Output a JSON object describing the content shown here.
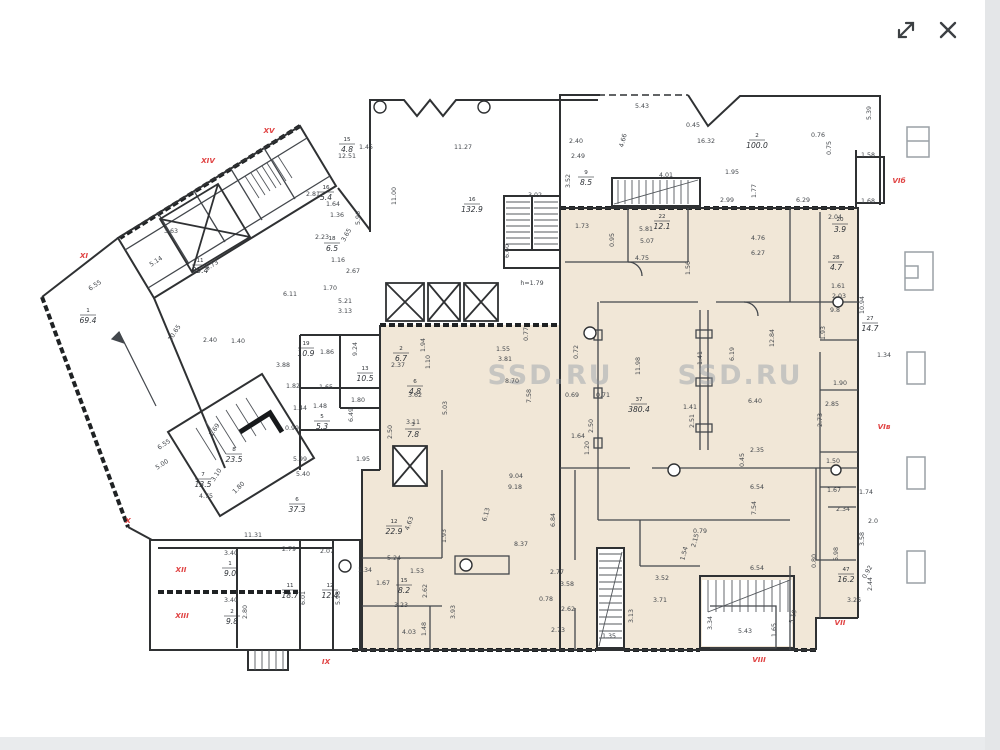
{
  "viewer": {
    "icons": [
      "expand-icon",
      "close-icon"
    ]
  },
  "watermark": {
    "text": "SSD.RU"
  },
  "colors": {
    "beige_zone": "#f1e7d7",
    "wall": "#2f3133",
    "red_label": "#e04343",
    "watermark_gray": "#8d97a3"
  },
  "plan": {
    "red_labels": [
      {
        "t": "XV",
        "x": 269,
        "y": 133
      },
      {
        "t": "XIV",
        "x": 208,
        "y": 163
      },
      {
        "t": "XI",
        "x": 84,
        "y": 258
      },
      {
        "t": "X",
        "x": 128,
        "y": 523
      },
      {
        "t": "XII",
        "x": 181,
        "y": 572
      },
      {
        "t": "XIII",
        "x": 182,
        "y": 618
      },
      {
        "t": "IX",
        "x": 326,
        "y": 664
      },
      {
        "t": "VIII",
        "x": 759,
        "y": 662
      },
      {
        "t": "VII",
        "x": 840,
        "y": 625
      },
      {
        "t": "VIб",
        "x": 899,
        "y": 183
      },
      {
        "t": "VIв",
        "x": 884,
        "y": 429
      }
    ],
    "rooms": [
      {
        "num": "11",
        "area": "35.4",
        "x": 200,
        "y": 270
      },
      {
        "num": "16",
        "area": "132.9",
        "x": 472,
        "y": 209
      },
      {
        "num": "2",
        "area": "100.0",
        "x": 757,
        "y": 145
      },
      {
        "num": "1",
        "area": "69.4",
        "x": 88,
        "y": 320
      },
      {
        "num": "7",
        "area": "13.5",
        "x": 203,
        "y": 484
      },
      {
        "num": "8",
        "area": "23.5",
        "x": 234,
        "y": 459
      },
      {
        "num": "6",
        "area": "37.3",
        "x": 297,
        "y": 509
      },
      {
        "num": "12",
        "area": "22.9",
        "x": 394,
        "y": 531
      },
      {
        "num": "37",
        "area": "380.4",
        "x": 639,
        "y": 409
      },
      {
        "num": "13",
        "area": "10.5",
        "x": 365,
        "y": 378
      },
      {
        "num": "47",
        "area": "16.2",
        "x": 846,
        "y": 579
      },
      {
        "num": "27",
        "area": "14.7",
        "x": 870,
        "y": 328
      },
      {
        "num": "1",
        "area": "9.0",
        "x": 230,
        "y": 573
      },
      {
        "num": "2",
        "area": "9.8",
        "x": 232,
        "y": 621
      },
      {
        "num": "15",
        "area": "8.2",
        "x": 404,
        "y": 590
      },
      {
        "num": "19",
        "area": "10.9",
        "x": 306,
        "y": 353
      },
      {
        "num": "22",
        "area": "12.1",
        "x": 662,
        "y": 226
      },
      {
        "num": "9",
        "area": "8.5",
        "x": 586,
        "y": 182
      },
      {
        "num": "2",
        "area": "6.7",
        "x": 401,
        "y": 358
      },
      {
        "num": "6",
        "area": "4.8",
        "x": 415,
        "y": 391
      },
      {
        "num": "3",
        "area": "7.8",
        "x": 413,
        "y": 434
      },
      {
        "num": "20",
        "area": "3.9",
        "x": 840,
        "y": 229
      },
      {
        "num": "28",
        "area": "4.7",
        "x": 836,
        "y": 267
      },
      {
        "num": "15",
        "area": "4.8",
        "x": 347,
        "y": 149
      },
      {
        "num": "16",
        "area": "5.4",
        "x": 326,
        "y": 197
      },
      {
        "num": "18",
        "area": "6.5",
        "x": 332,
        "y": 248
      },
      {
        "num": "5",
        "area": "5.3",
        "x": 322,
        "y": 426
      },
      {
        "num": "11",
        "area": "18.7",
        "x": 290,
        "y": 595
      },
      {
        "num": "12",
        "area": "12.4",
        "x": 330,
        "y": 595
      }
    ],
    "dims": [
      {
        "t": "3.63",
        "x": 171,
        "y": 233
      },
      {
        "t": "5.14",
        "x": 157,
        "y": 263,
        "r": -33
      },
      {
        "t": "6.55",
        "x": 96,
        "y": 287,
        "r": -33
      },
      {
        "t": "9.73",
        "x": 213,
        "y": 267,
        "r": -33
      },
      {
        "t": "10.65",
        "x": 176,
        "y": 334,
        "r": -57
      },
      {
        "t": "2.40",
        "x": 210,
        "y": 342
      },
      {
        "t": "1.40",
        "x": 238,
        "y": 343
      },
      {
        "t": "12.51",
        "x": 347,
        "y": 158
      },
      {
        "t": "1.45",
        "x": 366,
        "y": 149
      },
      {
        "t": "2.81",
        "x": 313,
        "y": 196
      },
      {
        "t": "1.64",
        "x": 333,
        "y": 206
      },
      {
        "t": "1.36",
        "x": 337,
        "y": 217
      },
      {
        "t": "5.96",
        "x": 360,
        "y": 218,
        "r": -90
      },
      {
        "t": "3.65",
        "x": 348,
        "y": 236,
        "r": -60
      },
      {
        "t": "2.23",
        "x": 322,
        "y": 239
      },
      {
        "t": "1.16",
        "x": 338,
        "y": 262
      },
      {
        "t": "2.67",
        "x": 353,
        "y": 273
      },
      {
        "t": "1.70",
        "x": 330,
        "y": 290
      },
      {
        "t": "5.21",
        "x": 345,
        "y": 303
      },
      {
        "t": "3.13",
        "x": 345,
        "y": 313
      },
      {
        "t": "6.11",
        "x": 290,
        "y": 296
      },
      {
        "t": "3.88",
        "x": 283,
        "y": 367
      },
      {
        "t": "1.86",
        "x": 327,
        "y": 354
      },
      {
        "t": "9.24",
        "x": 357,
        "y": 349,
        "r": -90
      },
      {
        "t": "2.37",
        "x": 398,
        "y": 367
      },
      {
        "t": "1.82",
        "x": 293,
        "y": 388
      },
      {
        "t": "1.65",
        "x": 326,
        "y": 389
      },
      {
        "t": "1.80",
        "x": 358,
        "y": 402
      },
      {
        "t": "6.49",
        "x": 353,
        "y": 415,
        "r": -90
      },
      {
        "t": "0.99",
        "x": 292,
        "y": 430
      },
      {
        "t": "1.44",
        "x": 300,
        "y": 410
      },
      {
        "t": "1.48",
        "x": 320,
        "y": 408
      },
      {
        "t": "3.11",
        "x": 413,
        "y": 424
      },
      {
        "t": "2.50",
        "x": 392,
        "y": 432,
        "r": -90
      },
      {
        "t": "1.10",
        "x": 430,
        "y": 362,
        "r": -90
      },
      {
        "t": "1.94",
        "x": 425,
        "y": 345,
        "r": -90
      },
      {
        "t": "3.62",
        "x": 415,
        "y": 397
      },
      {
        "t": "5.03",
        "x": 447,
        "y": 408,
        "r": -90
      },
      {
        "t": "5.99",
        "x": 300,
        "y": 461
      },
      {
        "t": "5.40",
        "x": 303,
        "y": 476
      },
      {
        "t": "1.95",
        "x": 363,
        "y": 461
      },
      {
        "t": "6.55",
        "x": 165,
        "y": 446,
        "r": -33
      },
      {
        "t": "5.00",
        "x": 163,
        "y": 466,
        "r": -33
      },
      {
        "t": "3.10",
        "x": 218,
        "y": 476,
        "r": -57
      },
      {
        "t": "1.69",
        "x": 216,
        "y": 431,
        "r": -57
      },
      {
        "t": "4.75",
        "x": 206,
        "y": 498
      },
      {
        "t": "1.80",
        "x": 240,
        "y": 489,
        "r": -45
      },
      {
        "t": "11.27",
        "x": 463,
        "y": 149
      },
      {
        "t": "11.00",
        "x": 396,
        "y": 196,
        "r": -90
      },
      {
        "t": "3.02",
        "x": 535,
        "y": 197
      },
      {
        "t": "6.60",
        "x": 509,
        "y": 251,
        "r": -90
      },
      {
        "t": "h=1.79",
        "x": 532,
        "y": 285
      },
      {
        "t": "2.40",
        "x": 576,
        "y": 143
      },
      {
        "t": "2.49",
        "x": 578,
        "y": 158
      },
      {
        "t": "3.52",
        "x": 570,
        "y": 181,
        "r": -90
      },
      {
        "t": "1.73",
        "x": 582,
        "y": 228
      },
      {
        "t": "0.95",
        "x": 614,
        "y": 240,
        "r": -90
      },
      {
        "t": "5.81",
        "x": 646,
        "y": 231
      },
      {
        "t": "5.07",
        "x": 647,
        "y": 243
      },
      {
        "t": "4.75",
        "x": 642,
        "y": 260
      },
      {
        "t": "1.56",
        "x": 690,
        "y": 268,
        "r": -90
      },
      {
        "t": "4.76",
        "x": 758,
        "y": 240
      },
      {
        "t": "6.27",
        "x": 758,
        "y": 255
      },
      {
        "t": "2.99",
        "x": 727,
        "y": 202
      },
      {
        "t": "1.95",
        "x": 732,
        "y": 174
      },
      {
        "t": "1.77",
        "x": 756,
        "y": 191,
        "r": -90
      },
      {
        "t": "6.29",
        "x": 803,
        "y": 202
      },
      {
        "t": "1.68",
        "x": 868,
        "y": 203
      },
      {
        "t": "1.58",
        "x": 868,
        "y": 157
      },
      {
        "t": "5.39",
        "x": 871,
        "y": 113,
        "r": -90
      },
      {
        "t": "0.76",
        "x": 818,
        "y": 137
      },
      {
        "t": "0.75",
        "x": 831,
        "y": 148,
        "r": -90
      },
      {
        "t": "4.01",
        "x": 666,
        "y": 177
      },
      {
        "t": "5.43",
        "x": 642,
        "y": 108
      },
      {
        "t": "0.45",
        "x": 693,
        "y": 127
      },
      {
        "t": "4.66",
        "x": 625,
        "y": 141,
        "r": -75
      },
      {
        "t": "16.32",
        "x": 706,
        "y": 143
      },
      {
        "t": "2.04",
        "x": 835,
        "y": 219
      },
      {
        "t": "2.03",
        "x": 839,
        "y": 298
      },
      {
        "t": "1.61",
        "x": 838,
        "y": 288
      },
      {
        "t": "9.8",
        "x": 835,
        "y": 312
      },
      {
        "t": "10.94",
        "x": 864,
        "y": 305,
        "r": -90
      },
      {
        "t": "1.93",
        "x": 825,
        "y": 333,
        "r": -90
      },
      {
        "t": "1.90",
        "x": 840,
        "y": 385
      },
      {
        "t": "1.34",
        "x": 884,
        "y": 357
      },
      {
        "t": "2.85",
        "x": 832,
        "y": 406
      },
      {
        "t": "2.73",
        "x": 822,
        "y": 420,
        "r": -90
      },
      {
        "t": "1.55",
        "x": 503,
        "y": 351
      },
      {
        "t": "3.81",
        "x": 505,
        "y": 361
      },
      {
        "t": "8.70",
        "x": 512,
        "y": 383
      },
      {
        "t": "7.58",
        "x": 531,
        "y": 396,
        "r": -90
      },
      {
        "t": "0.69",
        "x": 572,
        "y": 397
      },
      {
        "t": "0.71",
        "x": 603,
        "y": 397
      },
      {
        "t": "2.50",
        "x": 593,
        "y": 426,
        "r": -90
      },
      {
        "t": "0.72",
        "x": 578,
        "y": 352,
        "r": -90
      },
      {
        "t": "0.77",
        "x": 528,
        "y": 334,
        "r": -90
      },
      {
        "t": "11.98",
        "x": 640,
        "y": 366,
        "r": -90
      },
      {
        "t": "6.19",
        "x": 734,
        "y": 354,
        "r": -90
      },
      {
        "t": "12.84",
        "x": 774,
        "y": 338,
        "r": -90
      },
      {
        "t": "1.41",
        "x": 702,
        "y": 358,
        "r": -90
      },
      {
        "t": "1.41",
        "x": 690,
        "y": 409
      },
      {
        "t": "6.40",
        "x": 755,
        "y": 403
      },
      {
        "t": "2.51",
        "x": 694,
        "y": 421,
        "r": -90
      },
      {
        "t": "1.64",
        "x": 578,
        "y": 438
      },
      {
        "t": "2.35",
        "x": 757,
        "y": 452
      },
      {
        "t": "0.45",
        "x": 744,
        "y": 460,
        "r": -90
      },
      {
        "t": "6.54",
        "x": 757,
        "y": 489
      },
      {
        "t": "7.54",
        "x": 756,
        "y": 508,
        "r": -90
      },
      {
        "t": "1.20",
        "x": 589,
        "y": 448,
        "r": -90
      },
      {
        "t": "9.04",
        "x": 516,
        "y": 478
      },
      {
        "t": "9.18",
        "x": 515,
        "y": 489
      },
      {
        "t": "6.13",
        "x": 488,
        "y": 515,
        "r": -75
      },
      {
        "t": "6.84",
        "x": 555,
        "y": 520,
        "r": -90
      },
      {
        "t": "8.37",
        "x": 521,
        "y": 546
      },
      {
        "t": "4.63",
        "x": 411,
        "y": 524,
        "r": -70
      },
      {
        "t": "1.93",
        "x": 446,
        "y": 536,
        "r": -90
      },
      {
        "t": "5.24",
        "x": 394,
        "y": 560
      },
      {
        "t": "1.34",
        "x": 365,
        "y": 572
      },
      {
        "t": "1.53",
        "x": 417,
        "y": 573
      },
      {
        "t": "1.67",
        "x": 383,
        "y": 585
      },
      {
        "t": "3.23",
        "x": 401,
        "y": 607
      },
      {
        "t": "2.62",
        "x": 427,
        "y": 591,
        "r": -90
      },
      {
        "t": "4.03",
        "x": 409,
        "y": 634
      },
      {
        "t": "1.48",
        "x": 426,
        "y": 629,
        "r": -90
      },
      {
        "t": "3.93",
        "x": 455,
        "y": 612,
        "r": -90
      },
      {
        "t": "2.77",
        "x": 557,
        "y": 574
      },
      {
        "t": "3.58",
        "x": 567,
        "y": 586
      },
      {
        "t": "0.78",
        "x": 546,
        "y": 601
      },
      {
        "t": "2.62",
        "x": 568,
        "y": 611
      },
      {
        "t": "2.73",
        "x": 558,
        "y": 632
      },
      {
        "t": "1.50",
        "x": 833,
        "y": 463
      },
      {
        "t": "1.67",
        "x": 834,
        "y": 492
      },
      {
        "t": "1.74",
        "x": 866,
        "y": 494
      },
      {
        "t": "2.34",
        "x": 843,
        "y": 511
      },
      {
        "t": "2.0",
        "x": 873,
        "y": 523
      },
      {
        "t": "3.58",
        "x": 864,
        "y": 539,
        "r": -90
      },
      {
        "t": "5.98",
        "x": 838,
        "y": 554,
        "r": -90
      },
      {
        "t": "0.80",
        "x": 816,
        "y": 561,
        "r": -90
      },
      {
        "t": "0.92",
        "x": 869,
        "y": 573,
        "r": -60
      },
      {
        "t": "2.44",
        "x": 872,
        "y": 584,
        "r": -90
      },
      {
        "t": "3.26",
        "x": 854,
        "y": 602
      },
      {
        "t": "6.54",
        "x": 757,
        "y": 570
      },
      {
        "t": "3.52",
        "x": 662,
        "y": 580
      },
      {
        "t": "3.71",
        "x": 660,
        "y": 602
      },
      {
        "t": "3.13",
        "x": 633,
        "y": 616,
        "r": -90
      },
      {
        "t": "1.54",
        "x": 686,
        "y": 554,
        "r": -75
      },
      {
        "t": "2.15",
        "x": 697,
        "y": 541,
        "r": -75
      },
      {
        "t": "0.79",
        "x": 700,
        "y": 533
      },
      {
        "t": "5.43",
        "x": 745,
        "y": 633
      },
      {
        "t": "1.65",
        "x": 776,
        "y": 630,
        "r": -90
      },
      {
        "t": "3.34",
        "x": 712,
        "y": 623,
        "r": -90
      },
      {
        "t": "5.19",
        "x": 795,
        "y": 617,
        "r": -75
      },
      {
        "t": "1.35",
        "x": 609,
        "y": 638
      },
      {
        "t": "11.31",
        "x": 253,
        "y": 537
      },
      {
        "t": "2.79",
        "x": 289,
        "y": 551
      },
      {
        "t": "2.07",
        "x": 327,
        "y": 553
      },
      {
        "t": "3.40",
        "x": 231,
        "y": 555
      },
      {
        "t": "3.40",
        "x": 231,
        "y": 602
      },
      {
        "t": "6.01",
        "x": 305,
        "y": 598,
        "r": -90
      },
      {
        "t": "5.98",
        "x": 340,
        "y": 598,
        "r": -90
      },
      {
        "t": "2.80",
        "x": 247,
        "y": 612,
        "r": -90
      }
    ]
  }
}
